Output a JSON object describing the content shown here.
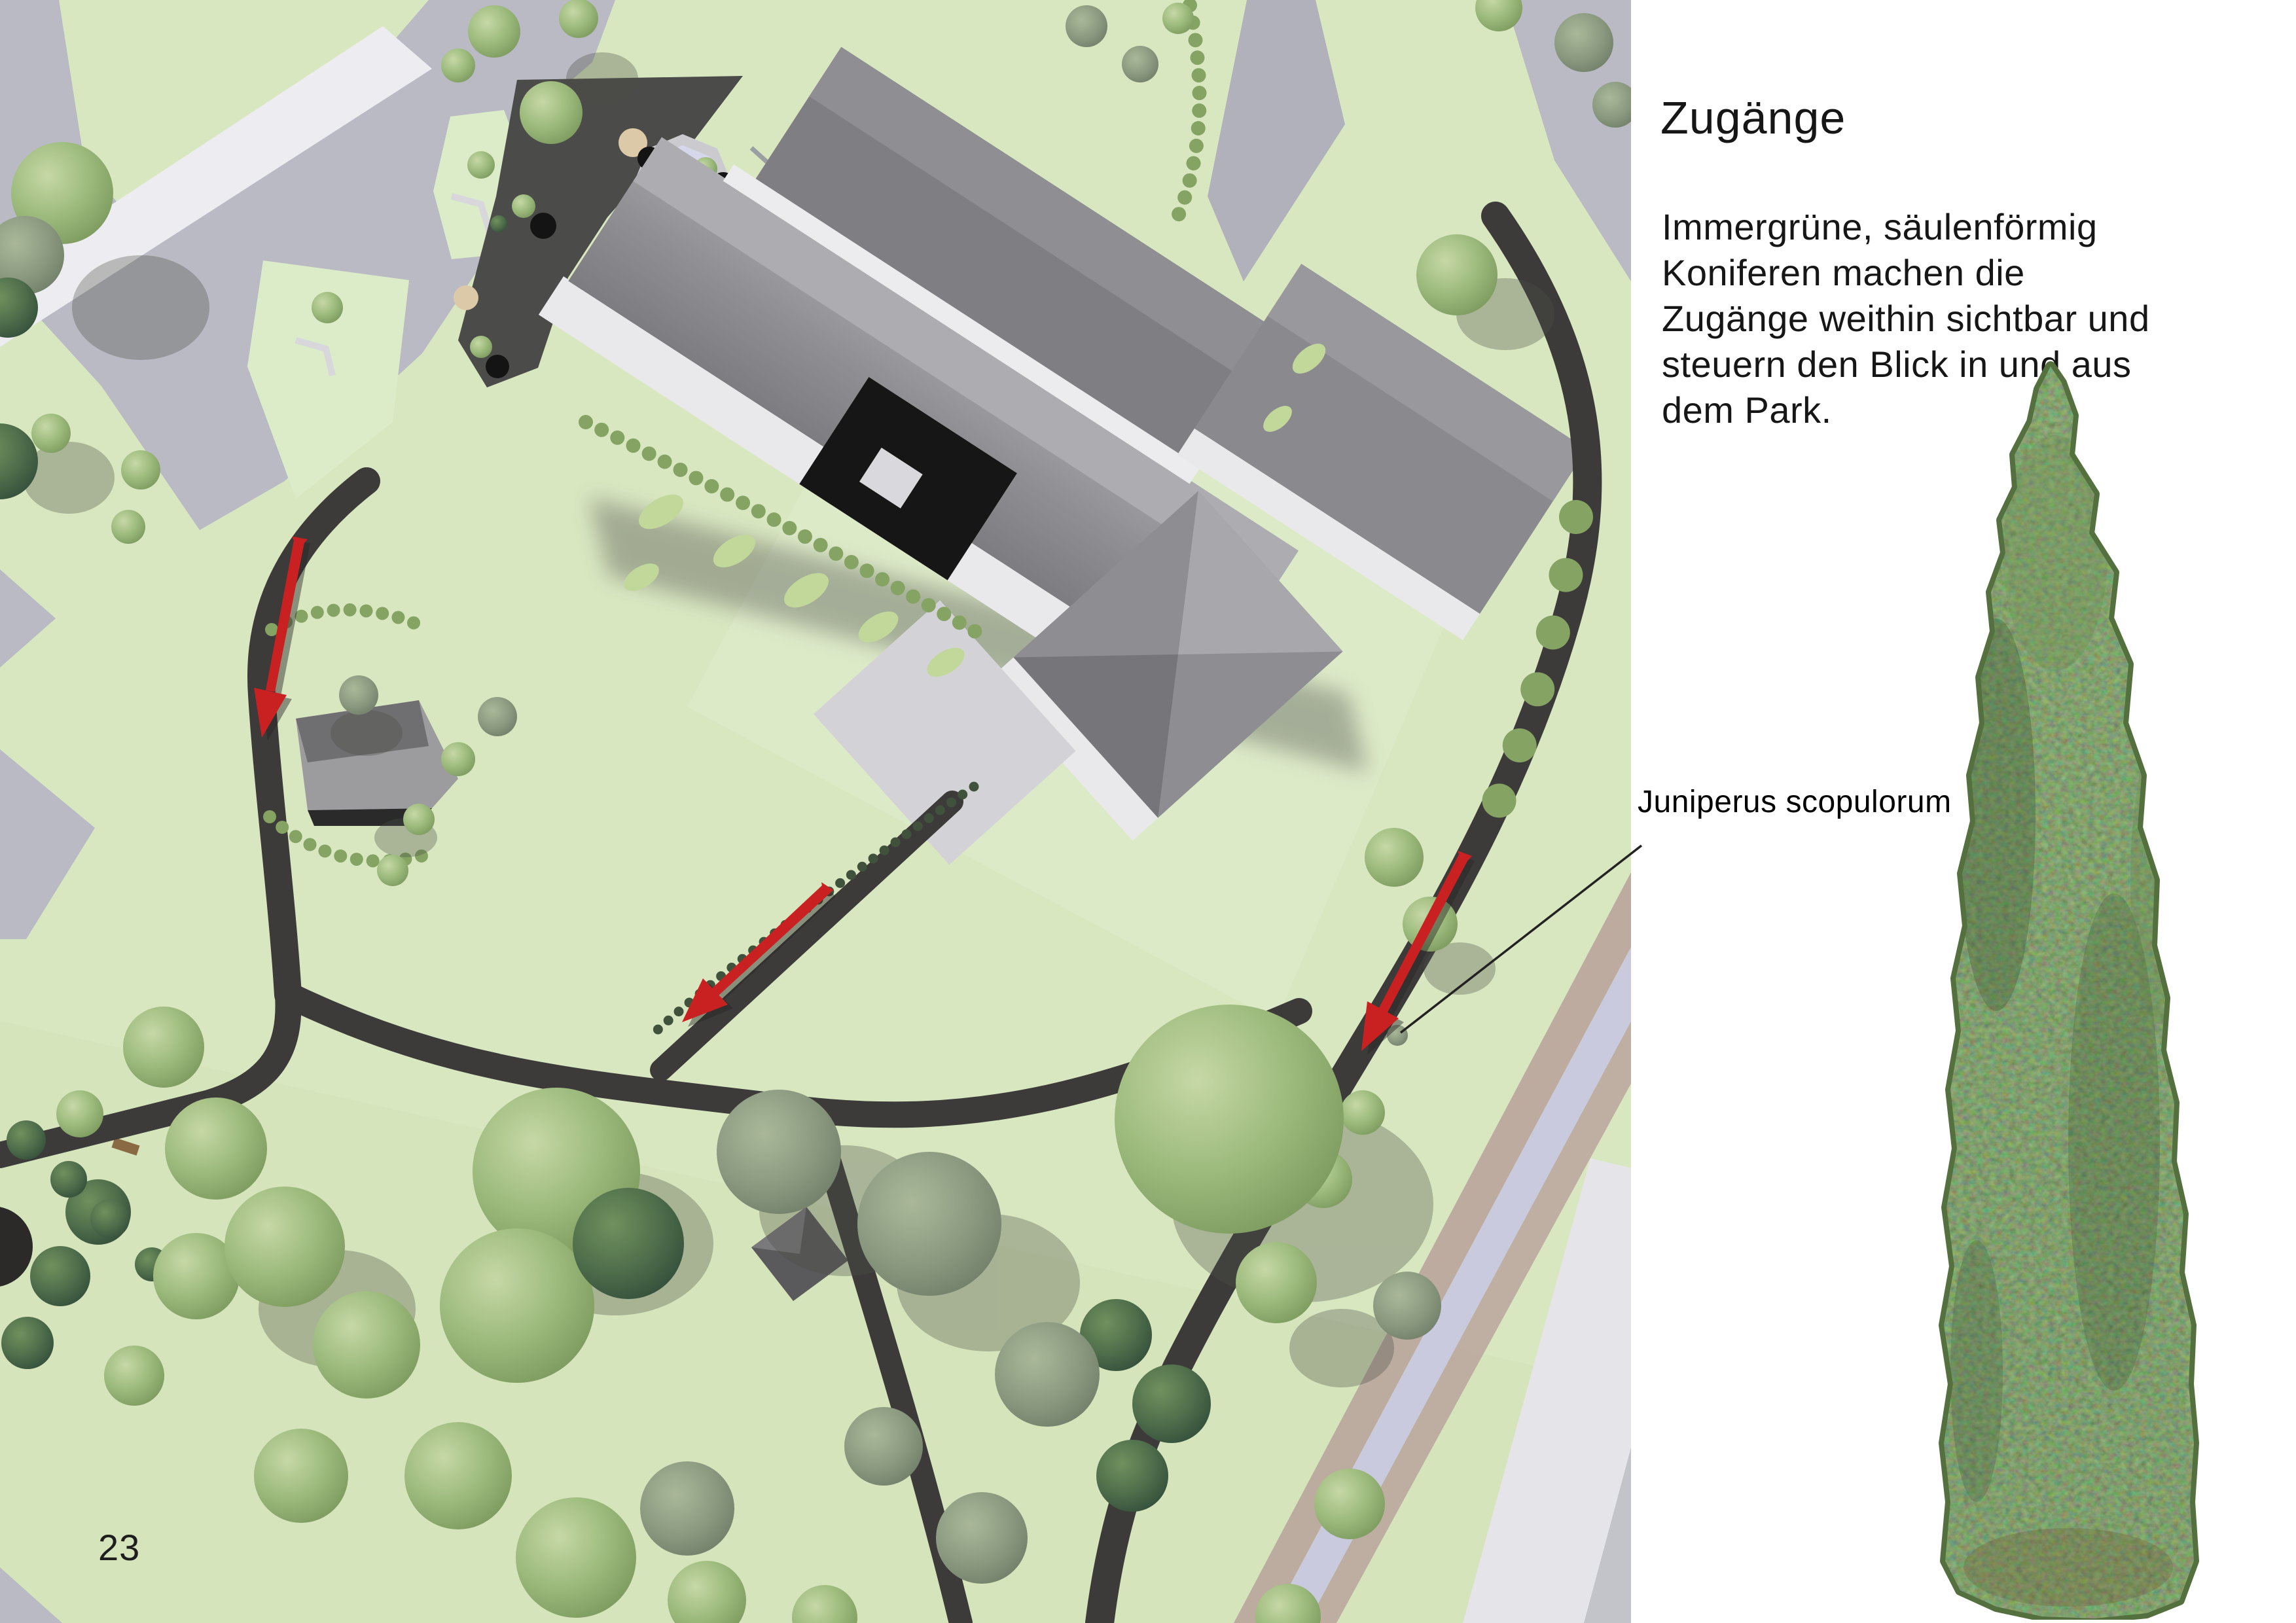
{
  "page": {
    "number": "23"
  },
  "sidebar": {
    "title": "Zugänge",
    "paragraph_lines": [
      "Immergrüne, säulenförmig",
      "Koniferen machen die",
      "Zugänge weithin sichtbar und",
      "steuern den Blick in und aus",
      "dem Park."
    ],
    "annotation_label": "Juniperus scopulorum"
  },
  "plan": {
    "kind": "landscape-site-plan",
    "arrow_count": 3,
    "colors": {
      "accent_arrow": "#c92121",
      "lawn": "#d9e7c1",
      "path": "#3d3b3a",
      "plaza": "#b9bac3",
      "hedge": "#85a363",
      "pond": "#d7d7ec",
      "street_lavender": "#c9cade",
      "street_mauve": "#b9a49c"
    }
  }
}
